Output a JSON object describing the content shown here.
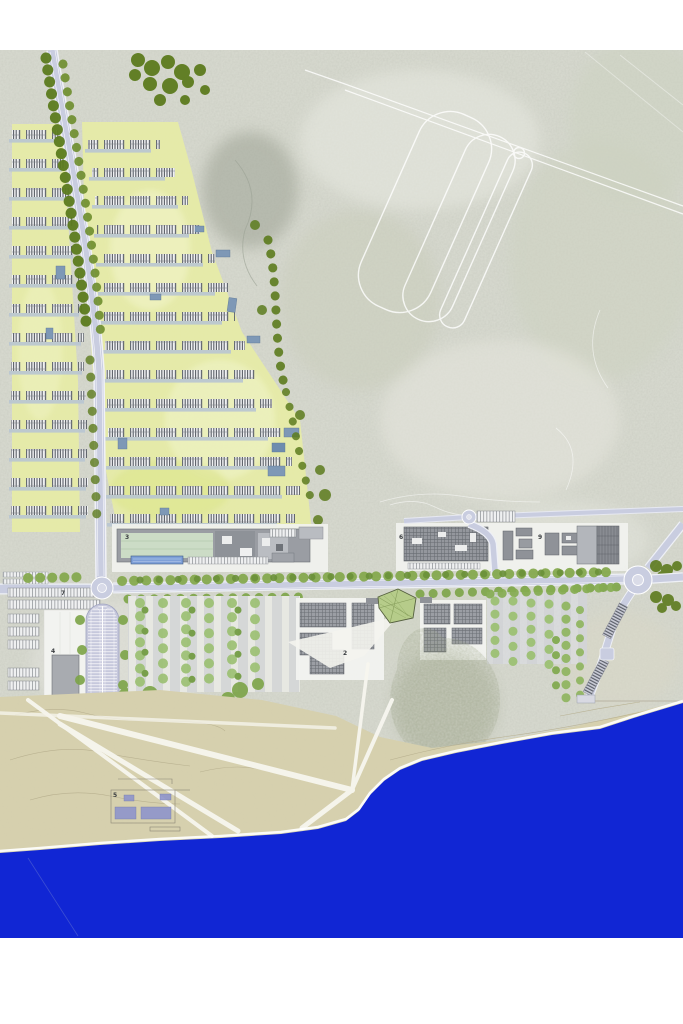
{
  "document": {
    "kind": "architectural-masterplan-site-plan",
    "orientation": "coastal site, sea at bottom"
  },
  "labels": {
    "n2": "2",
    "n3": "3",
    "n4": "4",
    "n5": "5",
    "n6": "6",
    "n7": "7",
    "n8": "8",
    "n9": "9"
  },
  "scale_bar": {
    "start": "0",
    "end": "50"
  },
  "colors": {
    "sea": "#1126d4",
    "sand": "#d7d1ae",
    "terrain": "#d9dbd1",
    "road": "#c9cde0",
    "road_casing": "#eef0f6",
    "tree_dark": "#5c7b1d",
    "tree_mid": "#7ca447",
    "tree_light": "#9bc071",
    "parcel": "#e6eba6",
    "building": "#9a9da3",
    "building_dark": "#5f6368",
    "deck": "#b8c5d1",
    "pool": "#7fa0d8",
    "plinth": "#f2f3f0",
    "ink": "#3a3d40",
    "faint": "#b0b0b0"
  }
}
